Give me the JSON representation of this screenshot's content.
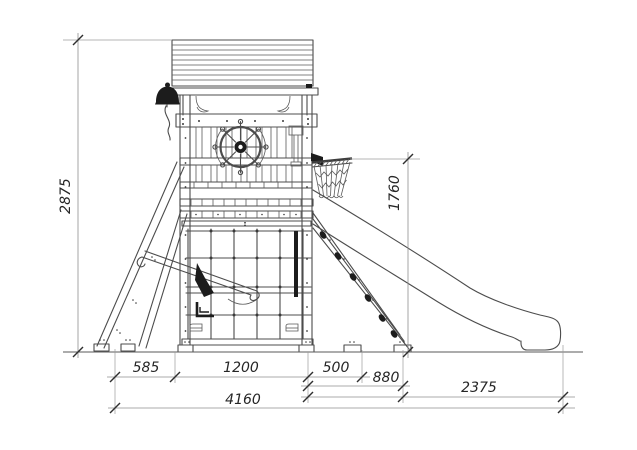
{
  "drawing": {
    "view_label": "side-elevation",
    "dimensions": {
      "overall_height": "2875",
      "platform_height": "1760",
      "base_left": "585",
      "base_center": "1200",
      "base_right": "500",
      "ramp_run": "880",
      "slide_run": "2375",
      "overall_width": "4160"
    },
    "parts": [
      "roof",
      "bell",
      "ship-wheel",
      "telescope",
      "balustrade",
      "deck-boards",
      "climbing-grid",
      "toddler-slide",
      "swing-seat",
      "a-frame-ladder",
      "climbing-ramp",
      "basketball-hoop",
      "slide"
    ],
    "colors": {
      "background": "#ffffff",
      "structure_line": "#4c4c4c",
      "dimension_line": "#8f8f8f",
      "tick": "#2f2f2f",
      "text": "#262626",
      "dark_fill": "#1c1c1c"
    }
  }
}
